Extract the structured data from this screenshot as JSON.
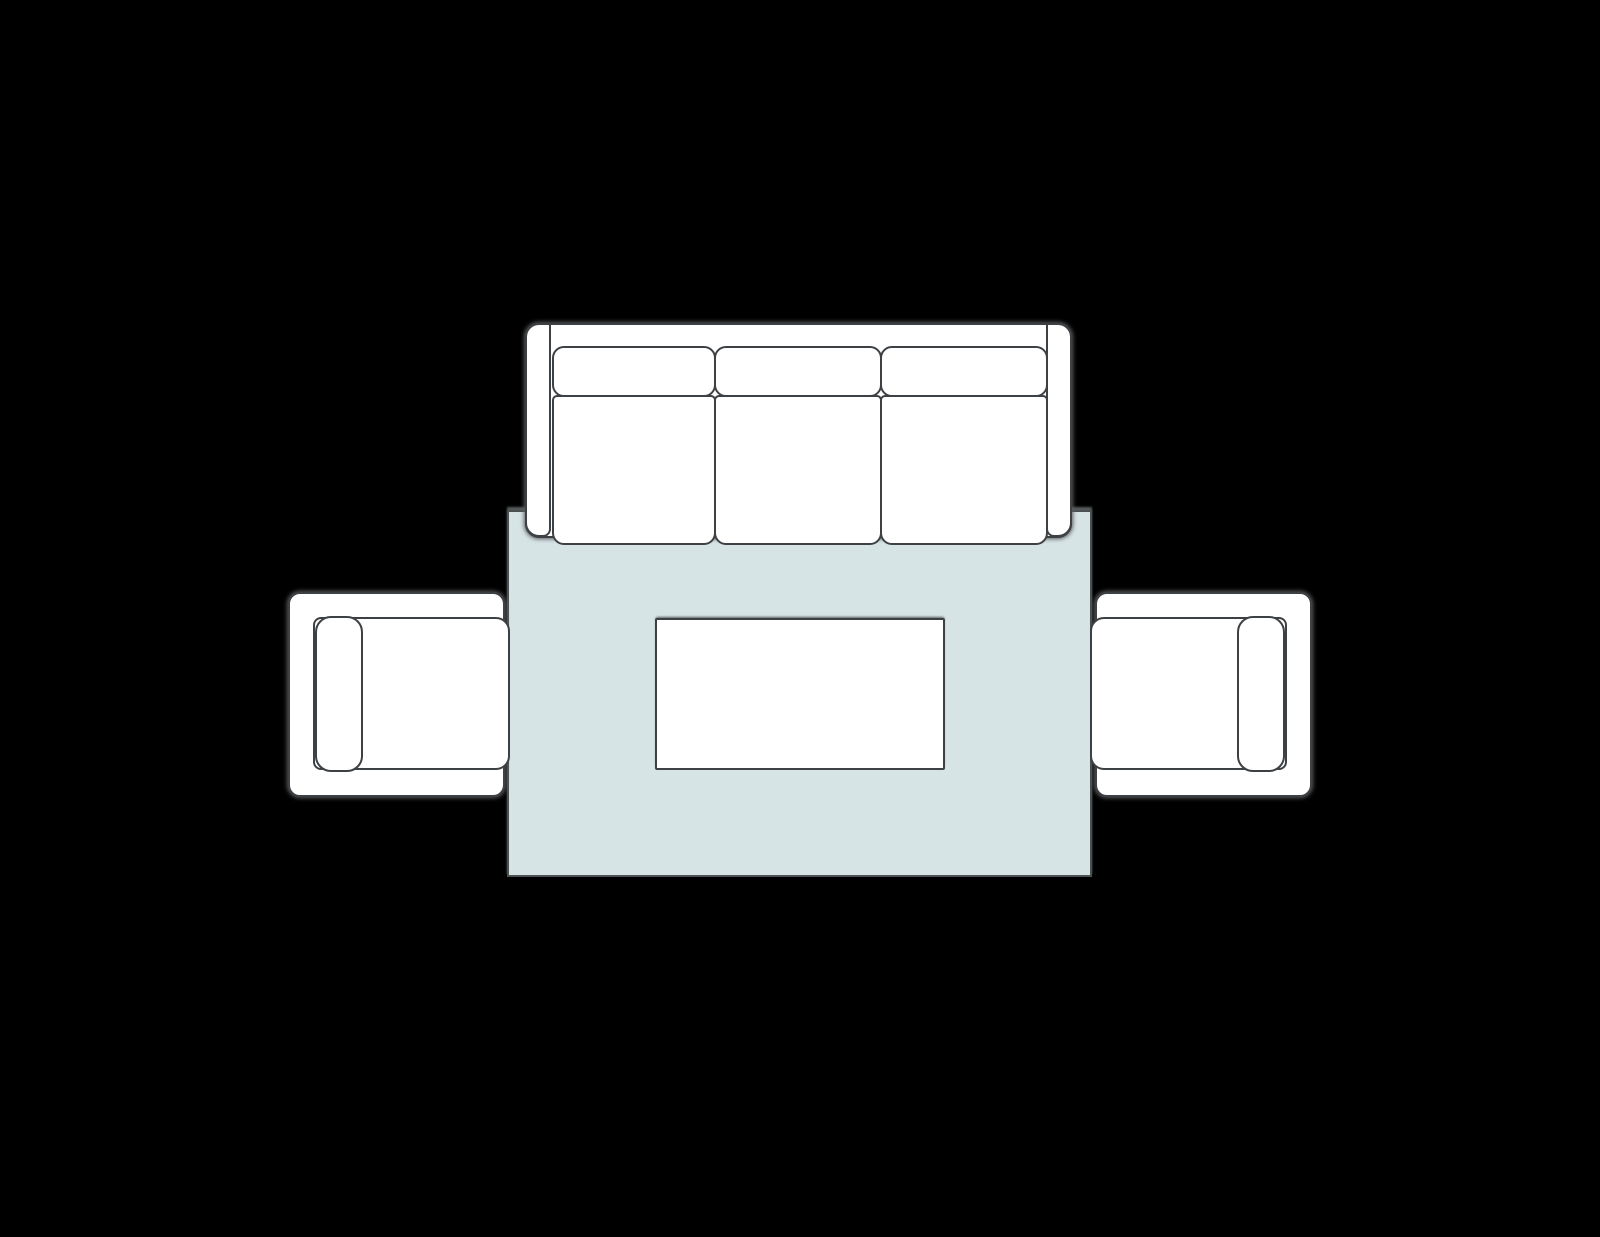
{
  "scene": {
    "type": "furniture-layout-plan",
    "view": "top-down",
    "canvas": {
      "width": 1600,
      "height": 1237
    }
  },
  "palette": {
    "background": "#000000",
    "furniture_fill": "#ffffff",
    "outline": "#3e4144",
    "rug_fill": "#d7e4e6",
    "rug_outline": "#4b5150",
    "shadow": "#585b5e"
  },
  "furniture": {
    "rug": {
      "label": "area rug",
      "geom": {
        "x": 507,
        "y": 510,
        "w": 585,
        "h": 367,
        "r": 0
      }
    },
    "sofa": {
      "label": "three-seat sofa",
      "body": {
        "x": 525,
        "y": 323,
        "w": 547,
        "h": 215,
        "r": 14
      },
      "arm_left": {
        "x": 525,
        "y": 323,
        "w": 26,
        "h": 214,
        "r": [
          14,
          2,
          8,
          14
        ]
      },
      "arm_right": {
        "x": 1046,
        "y": 323,
        "w": 26,
        "h": 214,
        "r": [
          2,
          14,
          14,
          8
        ]
      },
      "back_cushions": [
        {
          "x": 552,
          "y": 346,
          "w": 164,
          "h": 51,
          "r": 12
        },
        {
          "x": 714,
          "y": 346,
          "w": 168,
          "h": 51,
          "r": 12
        },
        {
          "x": 880,
          "y": 346,
          "w": 168,
          "h": 51,
          "r": 12
        }
      ],
      "seat_cushions": [
        {
          "x": 552,
          "y": 395,
          "w": 164,
          "h": 150,
          "r": [
            5,
            5,
            12,
            12
          ]
        },
        {
          "x": 714,
          "y": 395,
          "w": 168,
          "h": 150,
          "r": [
            5,
            5,
            12,
            12
          ]
        },
        {
          "x": 880,
          "y": 395,
          "w": 168,
          "h": 150,
          "r": [
            5,
            5,
            12,
            12
          ]
        }
      ]
    },
    "armchair_left": {
      "label": "armchair facing right",
      "body": {
        "x": 288,
        "y": 592,
        "w": 217,
        "h": 205,
        "r": 12
      },
      "seat": {
        "x": 313,
        "y": 617,
        "w": 197,
        "h": 153,
        "r": [
          8,
          14,
          14,
          8
        ]
      },
      "back_cushion": {
        "x": 315,
        "y": 616,
        "w": 48,
        "h": 156,
        "r": 16
      }
    },
    "armchair_right": {
      "label": "armchair facing left",
      "body": {
        "x": 1095,
        "y": 592,
        "w": 217,
        "h": 205,
        "r": 12
      },
      "seat": {
        "x": 1090,
        "y": 617,
        "w": 197,
        "h": 153,
        "r": [
          14,
          8,
          8,
          14
        ]
      },
      "back_cushion": {
        "x": 1237,
        "y": 616,
        "w": 48,
        "h": 156,
        "r": 16
      }
    },
    "coffee_table": {
      "label": "coffee table",
      "geom": {
        "x": 655,
        "y": 618,
        "w": 290,
        "h": 152,
        "r": 2
      }
    }
  }
}
